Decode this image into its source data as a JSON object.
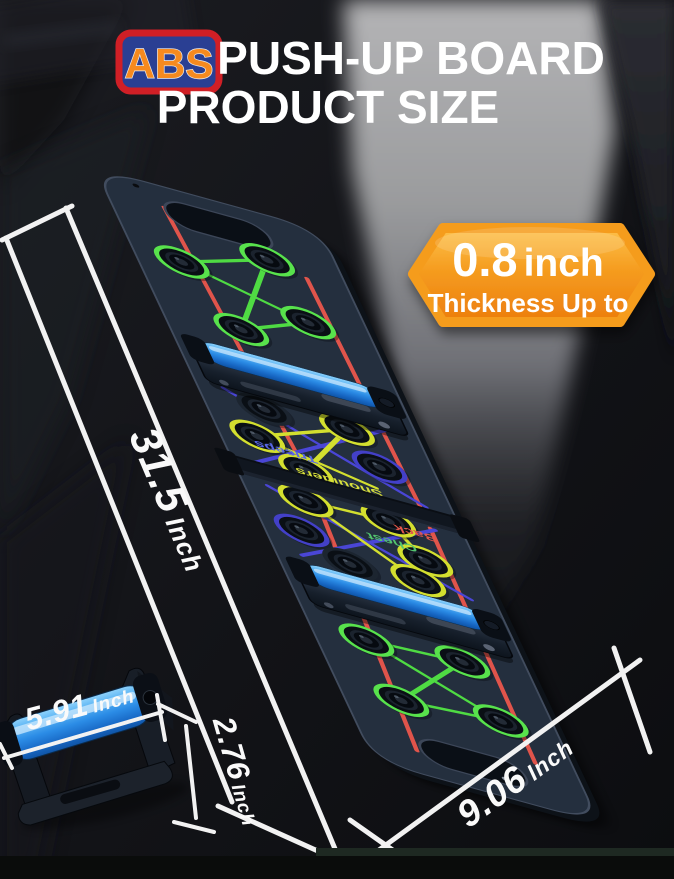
{
  "header": {
    "abs_badge": "ABS",
    "title": "PUSH-UP BOARD",
    "subtitle": "PRODUCT SIZE"
  },
  "thickness_badge": {
    "value": "0.8",
    "unit": "inch",
    "caption": "Thickness Up to"
  },
  "dimensions": {
    "length": {
      "value": "31.5",
      "unit": "Inch"
    },
    "width": {
      "value": "9.06",
      "unit": "Inch"
    },
    "folded_length": {
      "value": "5.91",
      "unit": "Inch"
    },
    "folded_height": {
      "value": "2.76",
      "unit": "Inch"
    }
  },
  "board_labels": {
    "back": "Back",
    "chest": "Chest",
    "shoulders": "Shoulders",
    "triceps": "Triceps"
  },
  "colors": {
    "abs_text": "#F68A1F",
    "abs_bg": "#2A3F93",
    "abs_border": "#D01F26",
    "badge_orange": "#F59C1F",
    "board_body": "#2B3646",
    "grip_blue": "#2B8CE6",
    "line_green": "#4FDB43",
    "line_yellow": "#D3DF2F",
    "line_blue": "#4A46D6",
    "line_red": "#E0544B",
    "dimension_text": "#FAFAFA"
  }
}
